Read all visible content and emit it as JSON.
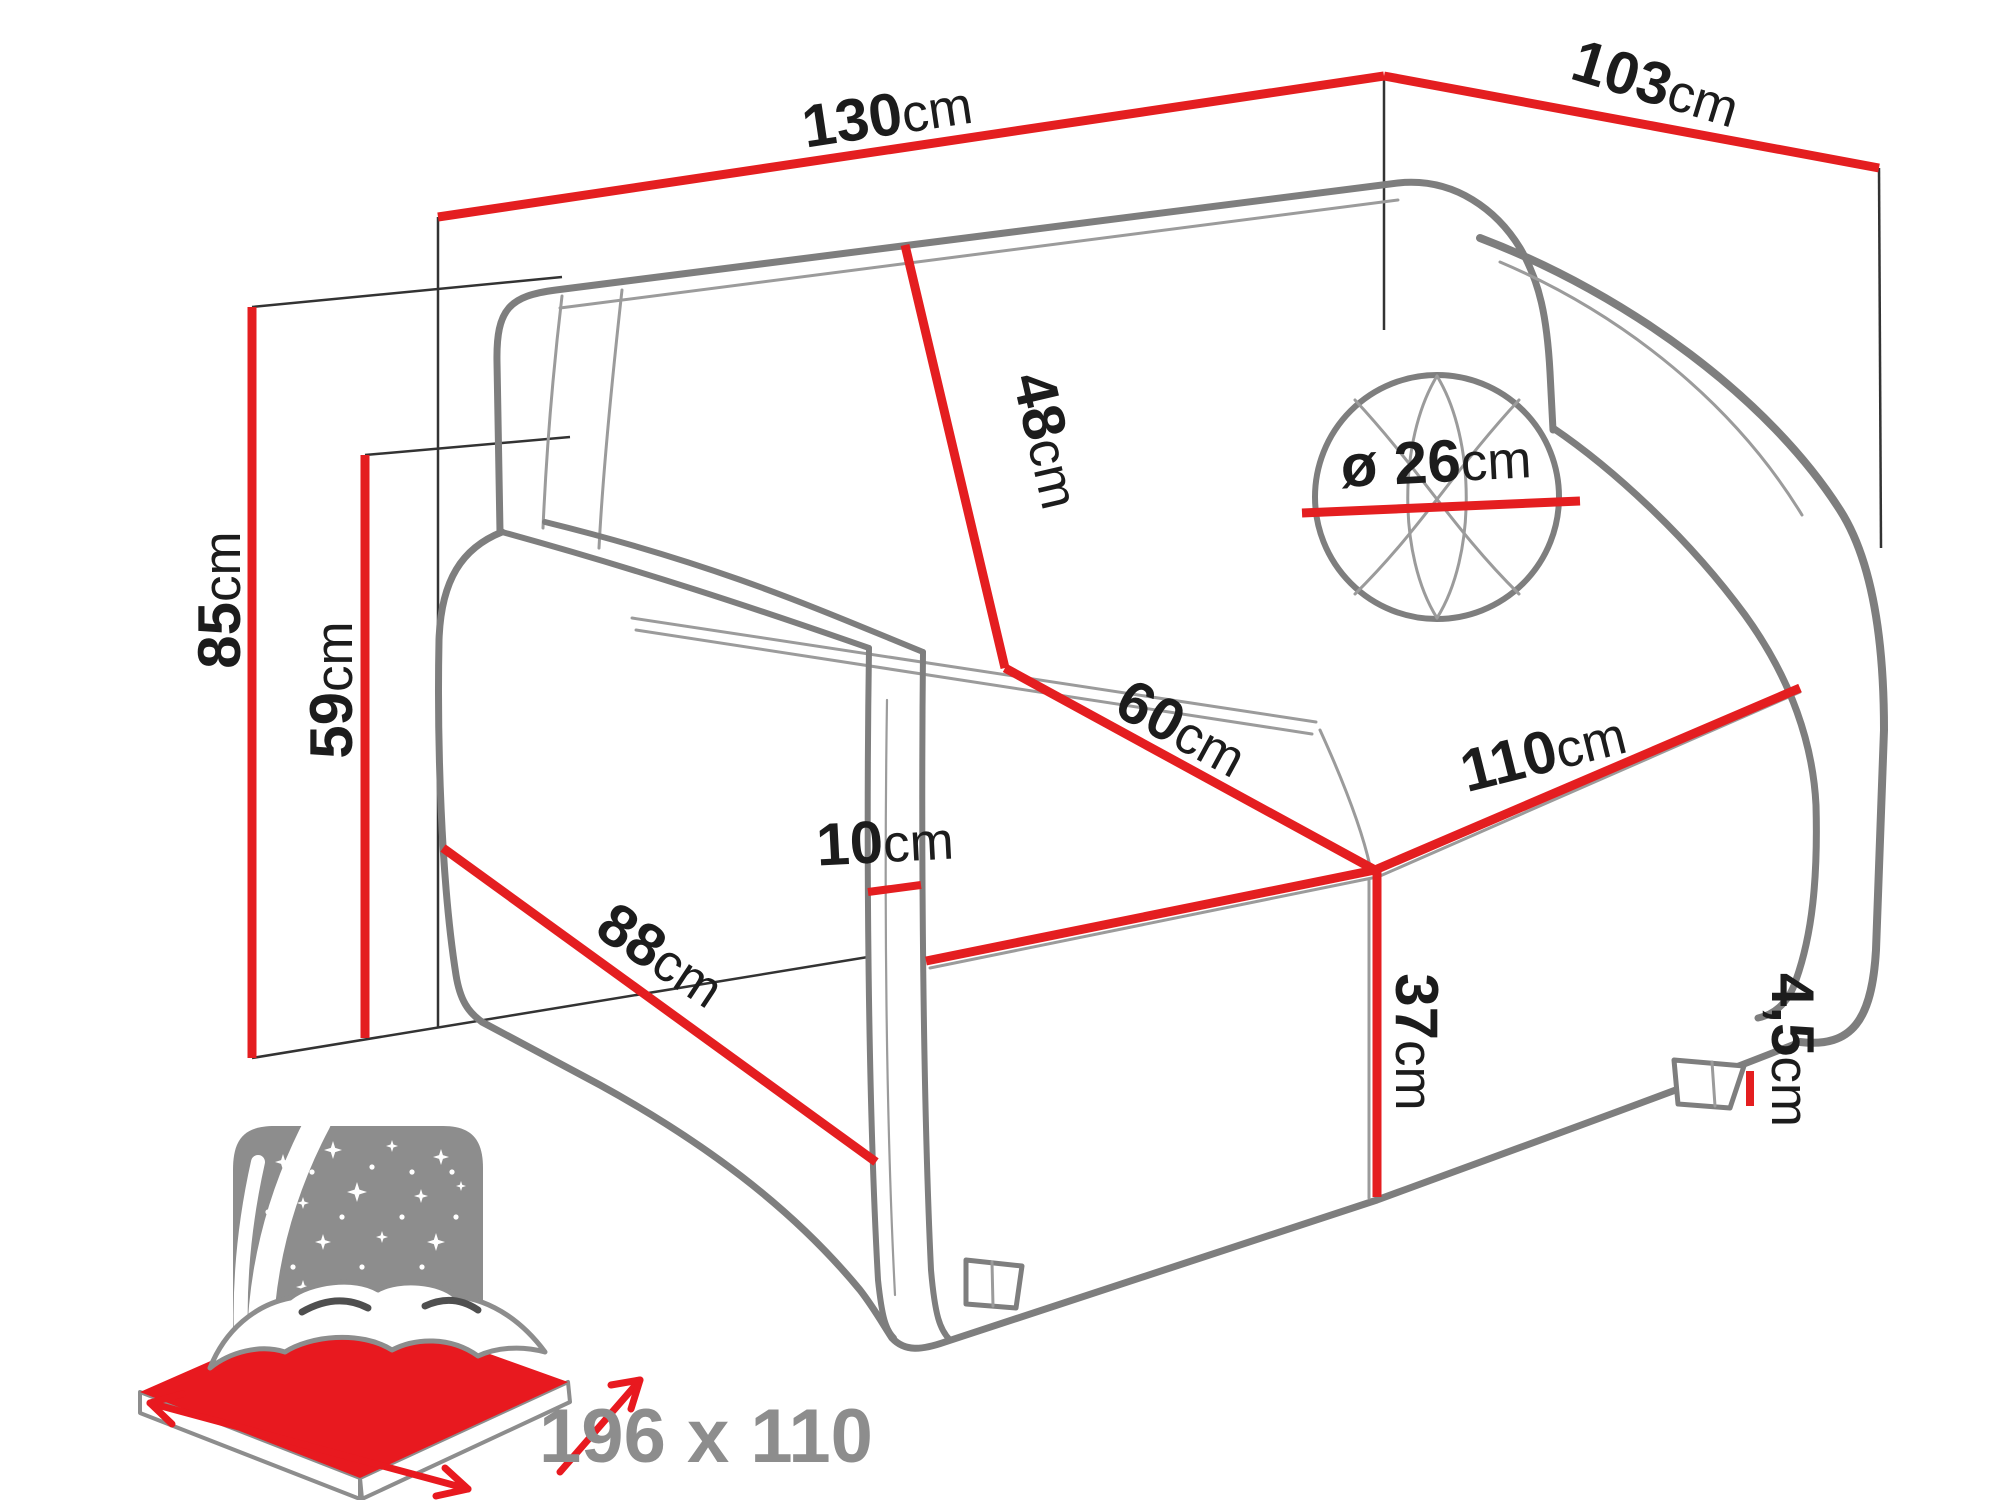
{
  "colors": {
    "dimension_red": "#e41e20",
    "bed_red": "#e8191f",
    "sofa_outline": "#7e7e7e",
    "sofa_seam": "#9b9b9b",
    "icon_gray": "#8d8d8d",
    "label_black": "#1c1c1c"
  },
  "dimensions": {
    "width_top": {
      "number": "130",
      "unit": "cm"
    },
    "depth_top": {
      "number": "103",
      "unit": "cm"
    },
    "height_total": {
      "number": "85",
      "unit": "cm"
    },
    "height_armrest": {
      "number": "59",
      "unit": "cm"
    },
    "backrest_height": {
      "number": "48",
      "unit": "cm"
    },
    "cushion_diameter": {
      "prefix": "ø ",
      "number": "26",
      "unit": "cm"
    },
    "seat_depth": {
      "number": "60",
      "unit": "cm"
    },
    "seat_width": {
      "number": "110",
      "unit": "cm"
    },
    "armrest_width": {
      "number": "10",
      "unit": "cm"
    },
    "front_width": {
      "number": "88",
      "unit": "cm"
    },
    "seat_height": {
      "number": "37",
      "unit": "cm"
    },
    "leg_height": {
      "number": "4,5",
      "unit": "cm"
    }
  },
  "bed_icon": {
    "sleeping_area": "196 x 110"
  }
}
